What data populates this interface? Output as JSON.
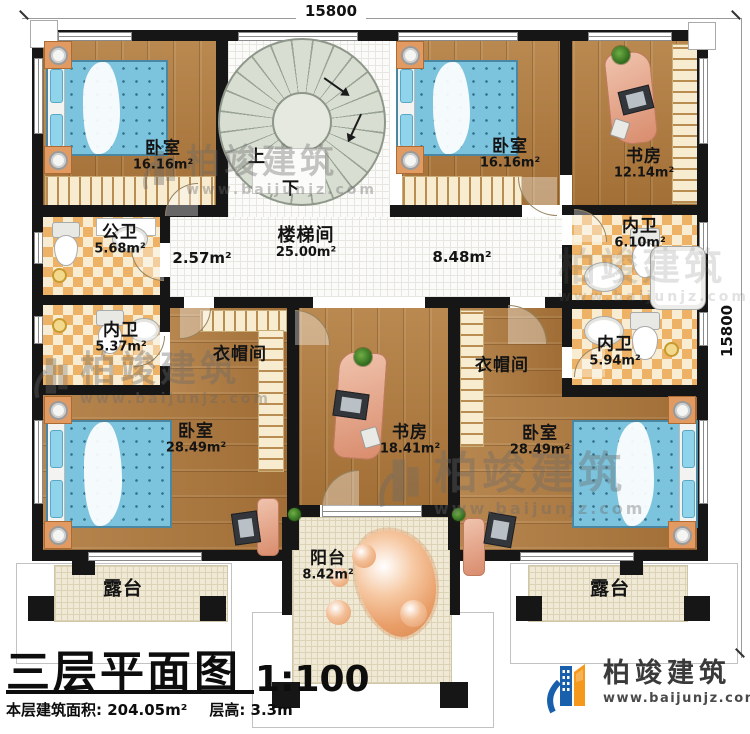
{
  "dimensions": {
    "top": "15800",
    "right": "15800"
  },
  "rooms": {
    "bedroom_tl": {
      "name": "卧室",
      "area": "16.16m²"
    },
    "stairwell": {
      "name": "楼梯间",
      "area": "25.00m²",
      "up": "上",
      "down": "下"
    },
    "bedroom_tm": {
      "name": "卧室",
      "area": "16.16m²"
    },
    "study_tr": {
      "name": "书房",
      "area": "12.14m²"
    },
    "bath_tr": {
      "name": "内卫",
      "area": "6.10m²"
    },
    "bath_public": {
      "name": "公卫",
      "area": "5.68m²"
    },
    "hall_small": {
      "area": "2.57m²"
    },
    "hall_main": {
      "area": "8.48m²"
    },
    "bath_left": {
      "name": "内卫",
      "area": "5.37m²"
    },
    "bath_right": {
      "name": "内卫",
      "area": "5.94m²"
    },
    "cloak_left": {
      "name": "衣帽间"
    },
    "cloak_right": {
      "name": "衣帽间"
    },
    "bedroom_bl": {
      "name": "卧室",
      "area": "28.49m²"
    },
    "study_bm": {
      "name": "书房",
      "area": "18.41m²"
    },
    "bedroom_br": {
      "name": "卧室",
      "area": "28.49m²"
    },
    "balcony": {
      "name": "阳台",
      "area": "8.42m²"
    },
    "terrace_left": {
      "name": "露台"
    },
    "terrace_right": {
      "name": "露台"
    }
  },
  "title": {
    "main": "三层平面图",
    "scale": "1:100",
    "area": "本层建筑面积: 204.05m²",
    "floor_height": "层高: 3.3m"
  },
  "brand": {
    "name": "柏竣建筑",
    "url": "www.baijunjz.com"
  },
  "colors": {
    "wall": "#161616",
    "wood": "#ae793d",
    "tile_orange": "#edb266",
    "bed_blue": "#7cc3dd",
    "logo_blue": "#1960ac",
    "logo_orange": "#f5991d"
  }
}
